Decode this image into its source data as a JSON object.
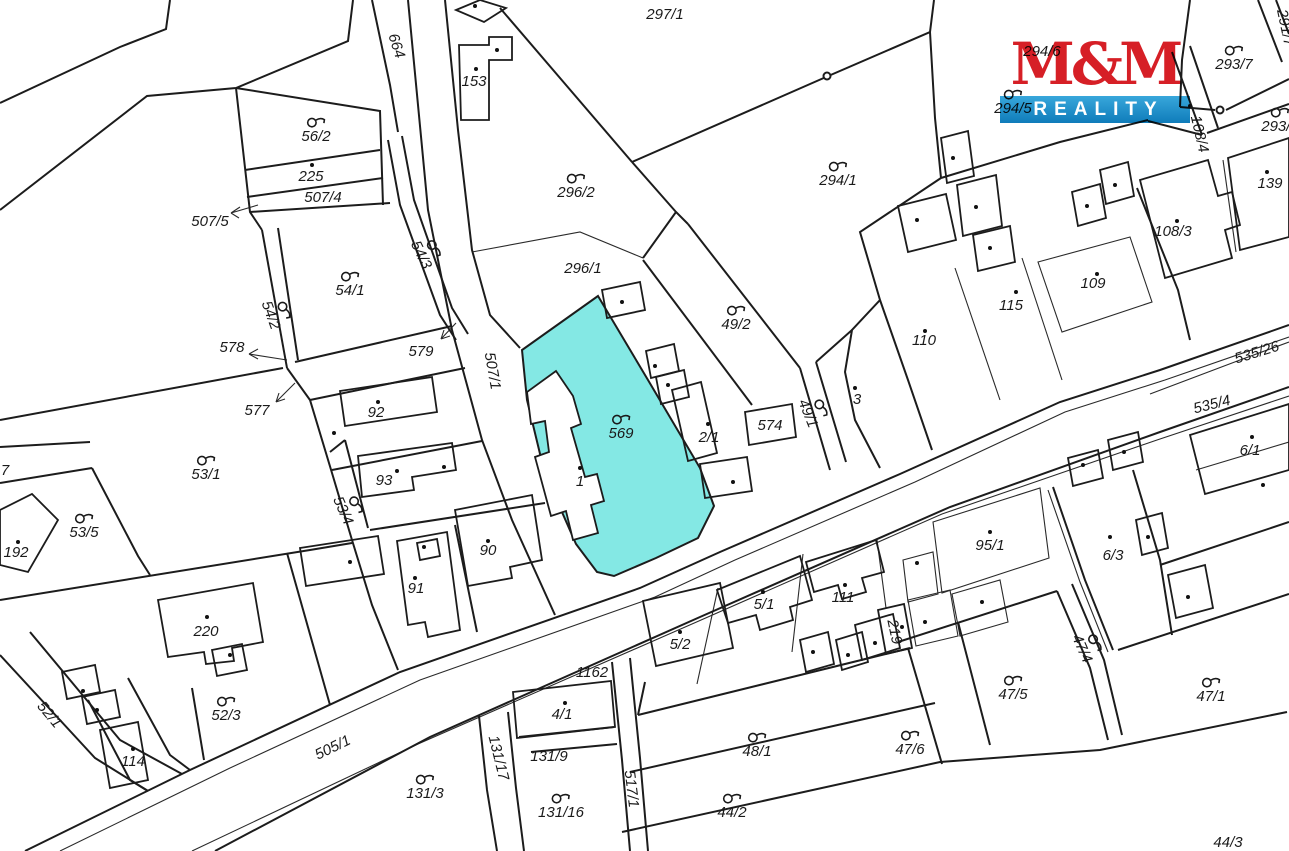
{
  "map": {
    "background": "#ffffff",
    "line_color": "#1c1c1c",
    "highlight": {
      "fill": "#84E8E4",
      "parcel_number": "569",
      "building_number": "1"
    },
    "logo": {
      "line1": "M&M",
      "line2": "REALITY",
      "red": "#d61f26",
      "blue_top": "#38a7db",
      "blue_bottom": "#0f7cba",
      "x": 1000,
      "y": 34
    },
    "ownership_icon_name": "ownership-link-icon",
    "parcels": [
      {
        "n": "297/1",
        "x": 665,
        "y": 15
      },
      {
        "n": "664",
        "x": 396,
        "y": 46,
        "r": 72
      },
      {
        "n": "153",
        "x": 474,
        "y": 82
      },
      {
        "n": "56/2",
        "x": 316,
        "y": 130,
        "s": 1
      },
      {
        "n": "225",
        "x": 311,
        "y": 177
      },
      {
        "n": "507/4",
        "x": 323,
        "y": 198
      },
      {
        "n": "507/5",
        "x": 210,
        "y": 222
      },
      {
        "n": "54/3",
        "x": 427,
        "y": 252,
        "r": 64,
        "s": 1
      },
      {
        "n": "54/1",
        "x": 350,
        "y": 284,
        "s": 1
      },
      {
        "n": "296/2",
        "x": 576,
        "y": 186,
        "s": 1
      },
      {
        "n": "296/1",
        "x": 583,
        "y": 269
      },
      {
        "n": "294/1",
        "x": 838,
        "y": 174,
        "s": 1
      },
      {
        "n": "294/6",
        "x": 1042,
        "y": 52
      },
      {
        "n": "294/5",
        "x": 1013,
        "y": 102,
        "s": 1
      },
      {
        "n": "293/7",
        "x": 1234,
        "y": 58,
        "s": 1
      },
      {
        "n": "291/7",
        "x": 1285,
        "y": 28,
        "r": 78
      },
      {
        "n": "293/9",
        "x": 1280,
        "y": 120,
        "s": 1
      },
      {
        "n": "108/4",
        "x": 1199,
        "y": 134,
        "r": 77
      },
      {
        "n": "139",
        "x": 1270,
        "y": 184
      },
      {
        "n": "108/3",
        "x": 1173,
        "y": 232
      },
      {
        "n": "109",
        "x": 1093,
        "y": 284
      },
      {
        "n": "115",
        "x": 1011,
        "y": 306
      },
      {
        "n": "110",
        "x": 924,
        "y": 341
      },
      {
        "n": "3",
        "x": 857,
        "y": 400
      },
      {
        "n": "49/2",
        "x": 736,
        "y": 318,
        "s": 1
      },
      {
        "n": "49/1",
        "x": 814,
        "y": 411,
        "r": 68,
        "s": 1
      },
      {
        "n": "574",
        "x": 770,
        "y": 426
      },
      {
        "n": "2/1",
        "x": 709,
        "y": 438
      },
      {
        "n": "569",
        "x": 621,
        "y": 427,
        "s": 1
      },
      {
        "n": "1",
        "x": 580,
        "y": 482
      },
      {
        "n": "578",
        "x": 232,
        "y": 348
      },
      {
        "n": "579",
        "x": 421,
        "y": 352
      },
      {
        "n": "577",
        "x": 257,
        "y": 411
      },
      {
        "n": "54/2",
        "x": 277,
        "y": 313,
        "r": 70,
        "s": 1
      },
      {
        "n": "507/1",
        "x": 492,
        "y": 371,
        "r": 80
      },
      {
        "n": "92",
        "x": 376,
        "y": 413
      },
      {
        "n": "53/1",
        "x": 206,
        "y": 468,
        "s": 1
      },
      {
        "n": "93",
        "x": 384,
        "y": 481
      },
      {
        "n": "53/4",
        "x": 349,
        "y": 508,
        "r": 66,
        "s": 1
      },
      {
        "n": "53/5",
        "x": 84,
        "y": 526,
        "s": 1
      },
      {
        "n": "192",
        "x": 16,
        "y": 553
      },
      {
        "n": "7",
        "x": 5,
        "y": 471
      },
      {
        "n": "90",
        "x": 488,
        "y": 551
      },
      {
        "n": "91",
        "x": 416,
        "y": 589
      },
      {
        "n": "220",
        "x": 206,
        "y": 632
      },
      {
        "n": "52/3",
        "x": 226,
        "y": 709,
        "s": 1
      },
      {
        "n": "52/1",
        "x": 49,
        "y": 715,
        "r": 50
      },
      {
        "n": "114",
        "x": 133,
        "y": 762
      },
      {
        "n": "131/3",
        "x": 425,
        "y": 787,
        "s": 1
      },
      {
        "n": "505/1",
        "x": 333,
        "y": 748,
        "r": -26
      },
      {
        "n": "1162",
        "x": 592,
        "y": 673
      },
      {
        "n": "4/1",
        "x": 562,
        "y": 715
      },
      {
        "n": "131/17",
        "x": 498,
        "y": 758,
        "r": 76
      },
      {
        "n": "131/9",
        "x": 549,
        "y": 757
      },
      {
        "n": "131/16",
        "x": 561,
        "y": 806,
        "s": 1
      },
      {
        "n": "517/1",
        "x": 631,
        "y": 789,
        "r": 83
      },
      {
        "n": "5/2",
        "x": 680,
        "y": 645
      },
      {
        "n": "5/1",
        "x": 764,
        "y": 605
      },
      {
        "n": "111",
        "x": 843,
        "y": 598
      },
      {
        "n": "219",
        "x": 894,
        "y": 632,
        "r": 78
      },
      {
        "n": "48/1",
        "x": 757,
        "y": 745,
        "s": 1
      },
      {
        "n": "44/2",
        "x": 732,
        "y": 806,
        "s": 1
      },
      {
        "n": "47/6",
        "x": 910,
        "y": 743,
        "s": 1
      },
      {
        "n": "47/5",
        "x": 1013,
        "y": 688,
        "s": 1
      },
      {
        "n": "47/4",
        "x": 1088,
        "y": 646,
        "r": 66,
        "s": 1
      },
      {
        "n": "47/1",
        "x": 1211,
        "y": 690,
        "s": 1
      },
      {
        "n": "95/1",
        "x": 990,
        "y": 546
      },
      {
        "n": "6/3",
        "x": 1113,
        "y": 556
      },
      {
        "n": "6/1",
        "x": 1250,
        "y": 451
      },
      {
        "n": "535/26",
        "x": 1257,
        "y": 353,
        "r": -17
      },
      {
        "n": "535/4",
        "x": 1212,
        "y": 405,
        "r": -14
      },
      {
        "n": "44/3",
        "x": 1228,
        "y": 843
      }
    ],
    "building_dots": [
      [
        475,
        6
      ],
      [
        497,
        50
      ],
      [
        476,
        69
      ],
      [
        312,
        165
      ],
      [
        378,
        402
      ],
      [
        334,
        433
      ],
      [
        397,
        471
      ],
      [
        444,
        467
      ],
      [
        488,
        541
      ],
      [
        415,
        578
      ],
      [
        424,
        547
      ],
      [
        350,
        562
      ],
      [
        18,
        542
      ],
      [
        207,
        617
      ],
      [
        230,
        655
      ],
      [
        83,
        691
      ],
      [
        97,
        710
      ],
      [
        133,
        749
      ],
      [
        565,
        703
      ],
      [
        680,
        632
      ],
      [
        763,
        592
      ],
      [
        813,
        652
      ],
      [
        848,
        655
      ],
      [
        845,
        585
      ],
      [
        875,
        643
      ],
      [
        902,
        627
      ],
      [
        925,
        622
      ],
      [
        990,
        532
      ],
      [
        917,
        563
      ],
      [
        982,
        602
      ],
      [
        1110,
        537
      ],
      [
        1083,
        465
      ],
      [
        1124,
        452
      ],
      [
        1148,
        537
      ],
      [
        1188,
        597
      ],
      [
        1252,
        437
      ],
      [
        1263,
        485
      ],
      [
        953,
        158
      ],
      [
        976,
        207
      ],
      [
        990,
        248
      ],
      [
        917,
        220
      ],
      [
        925,
        331
      ],
      [
        1016,
        292
      ],
      [
        1097,
        274
      ],
      [
        1087,
        206
      ],
      [
        1115,
        185
      ],
      [
        1177,
        221
      ],
      [
        1267,
        172
      ],
      [
        580,
        468
      ],
      [
        708,
        424
      ],
      [
        655,
        366
      ],
      [
        668,
        385
      ],
      [
        733,
        482
      ],
      [
        622,
        302
      ],
      [
        855,
        388
      ],
      [
        1190,
        106
      ]
    ],
    "boundary_markers": [
      [
        827,
        76
      ],
      [
        1220,
        110
      ]
    ]
  }
}
